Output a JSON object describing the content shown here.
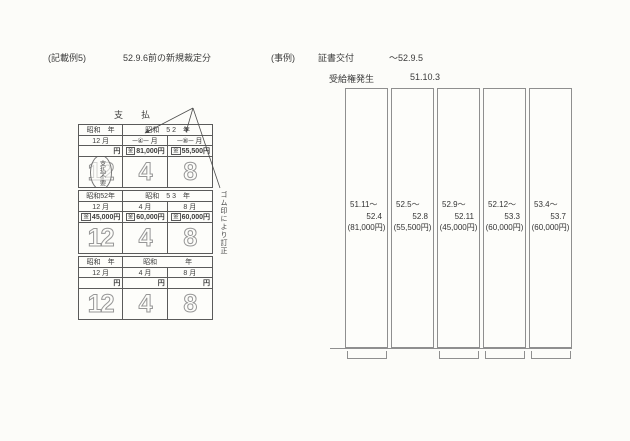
{
  "header": {
    "example_tag": "(記載例5)",
    "example_title": "52.9.6前の新規裁定分",
    "case_tag": "(事例)",
    "cert_label": "証書交付",
    "cert_period": "～52.9.5",
    "entitlement_label": "受給権発生",
    "entitlement_date": "51.10.3"
  },
  "form": {
    "title": "支　　払",
    "correction_note": "ゴム印により訂正",
    "exempt_stamp": "支払不要",
    "sections": [
      {
        "year_left": "昭和　年",
        "year_right": "昭和　5 2　年",
        "months": [
          "12 月",
          "─④─ 月",
          "─⑧─ 月"
        ],
        "amounts": [
          {
            "box": "",
            "text": "円"
          },
          {
            "box": "金",
            "text": "81,000円"
          },
          {
            "box": "金",
            "text": "55,500円"
          }
        ],
        "bigs": [
          "12",
          "4",
          "8"
        ]
      },
      {
        "year_left": "昭和52年",
        "year_right": "昭和　5 3　年",
        "months": [
          "12 月",
          "4 月",
          "8 月"
        ],
        "amounts": [
          {
            "box": "金",
            "text": "45,000円"
          },
          {
            "box": "金",
            "text": "60,000円"
          },
          {
            "box": "金",
            "text": "60,000円"
          }
        ],
        "bigs": [
          "12",
          "4",
          "8"
        ]
      },
      {
        "year_left": "昭和　年",
        "year_right": "昭和　　　　年",
        "months": [
          "12 月",
          "4 月",
          "8 月"
        ],
        "amounts": [
          {
            "box": "",
            "text": "円"
          },
          {
            "box": "",
            "text": "円"
          },
          {
            "box": "",
            "text": "円"
          }
        ],
        "bigs": [
          "12",
          "4",
          "8"
        ]
      }
    ]
  },
  "chart": {
    "type": "table",
    "columns": [
      {
        "from": "51.11～",
        "to": "52.4",
        "amount": "(81,000円)"
      },
      {
        "from": "52.5～",
        "to": "52.8",
        "amount": "(55,500円)"
      },
      {
        "from": "52.9～",
        "to": "52.11",
        "amount": "(45,000円)"
      },
      {
        "from": "52.12～",
        "to": "53.3",
        "amount": "(60,000円)"
      },
      {
        "from": "53.4～",
        "to": "53.7",
        "amount": "(60,000円)"
      }
    ]
  }
}
